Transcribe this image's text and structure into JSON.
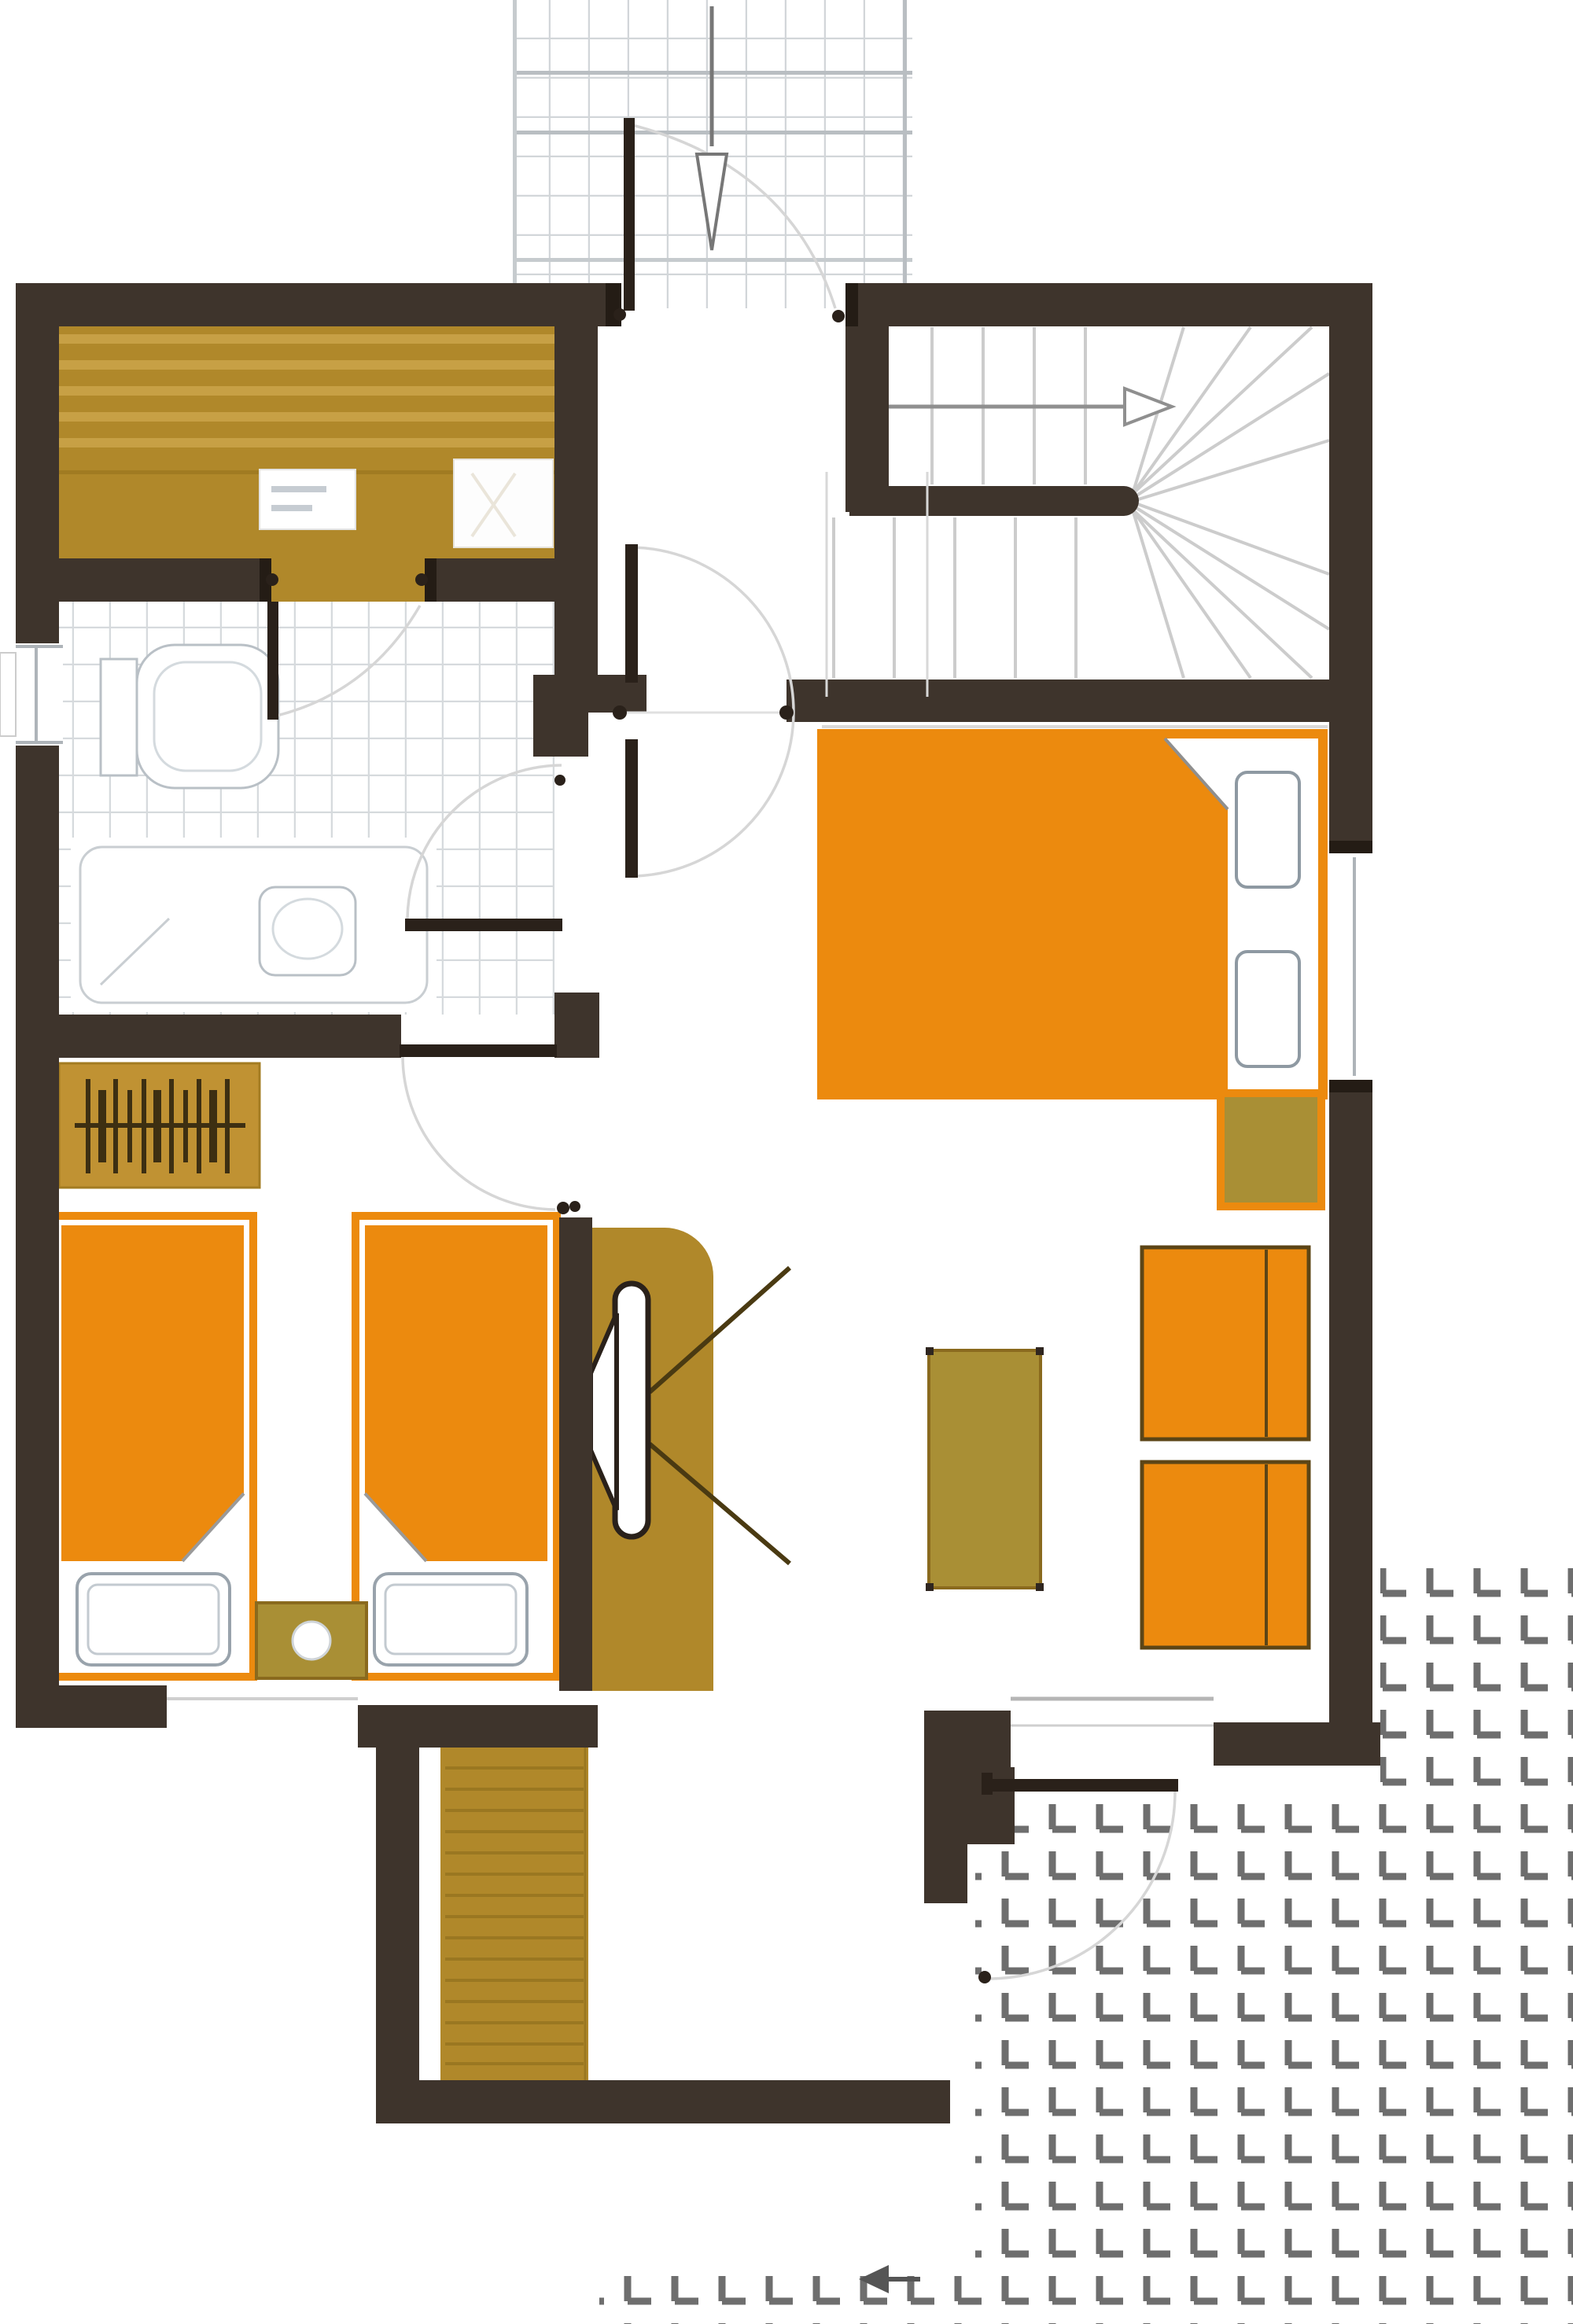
{
  "document": {
    "kind": "architectural-floor-plan",
    "visible_text": [],
    "notes": "one-storey cottage plan: sauna, bathroom, hall with winder staircase, double bedroom, twin bedroom, living area with fireplace, basement stair, entrance walkway and paved terrace"
  },
  "colors": {
    "wall": "#3e342c",
    "wall_dark": "#241c15",
    "leaf": "#2a211a",
    "gold": "#b0882a",
    "gold_light": "#c7a045",
    "gold_olive": "#a98f35",
    "gold_deep": "#9a7721",
    "orange": "#ec8a0e",
    "orange_border": "#d97d06",
    "chair_border": "#5c4516",
    "tile_line": "#d6dadd",
    "walk_line": "#d2d6d9",
    "walk_line_dark": "#b9bec2",
    "paver": "#6e6e6e",
    "arc": "#d6d6d6",
    "tread": "#cccccc",
    "stair_arrow": "#8f8f8f",
    "glass": "#aeb4b9",
    "fixture": "#b9c0c6",
    "fixture_light": "#d4dade",
    "bg": "#ffffff"
  },
  "icons": {
    "entrance-arrow": "open arrowhead pointing down into entrance door",
    "stair-direction-arrow": "arrow pointing right along upper stair flight",
    "terrace-arrow": "small solid arrow pointing left on terrace paving",
    "fireplace-icon": "stove slot with hearth trapezoid and radiating lines",
    "hanger-rail-icon": "wardrobe rail with hanger strokes"
  },
  "counts": {
    "double_beds": 1,
    "single_beds": 2,
    "armchairs": 2,
    "nightstands": 2,
    "coffee_tables": 1,
    "doors_with_swing": 6,
    "windows": 3
  }
}
